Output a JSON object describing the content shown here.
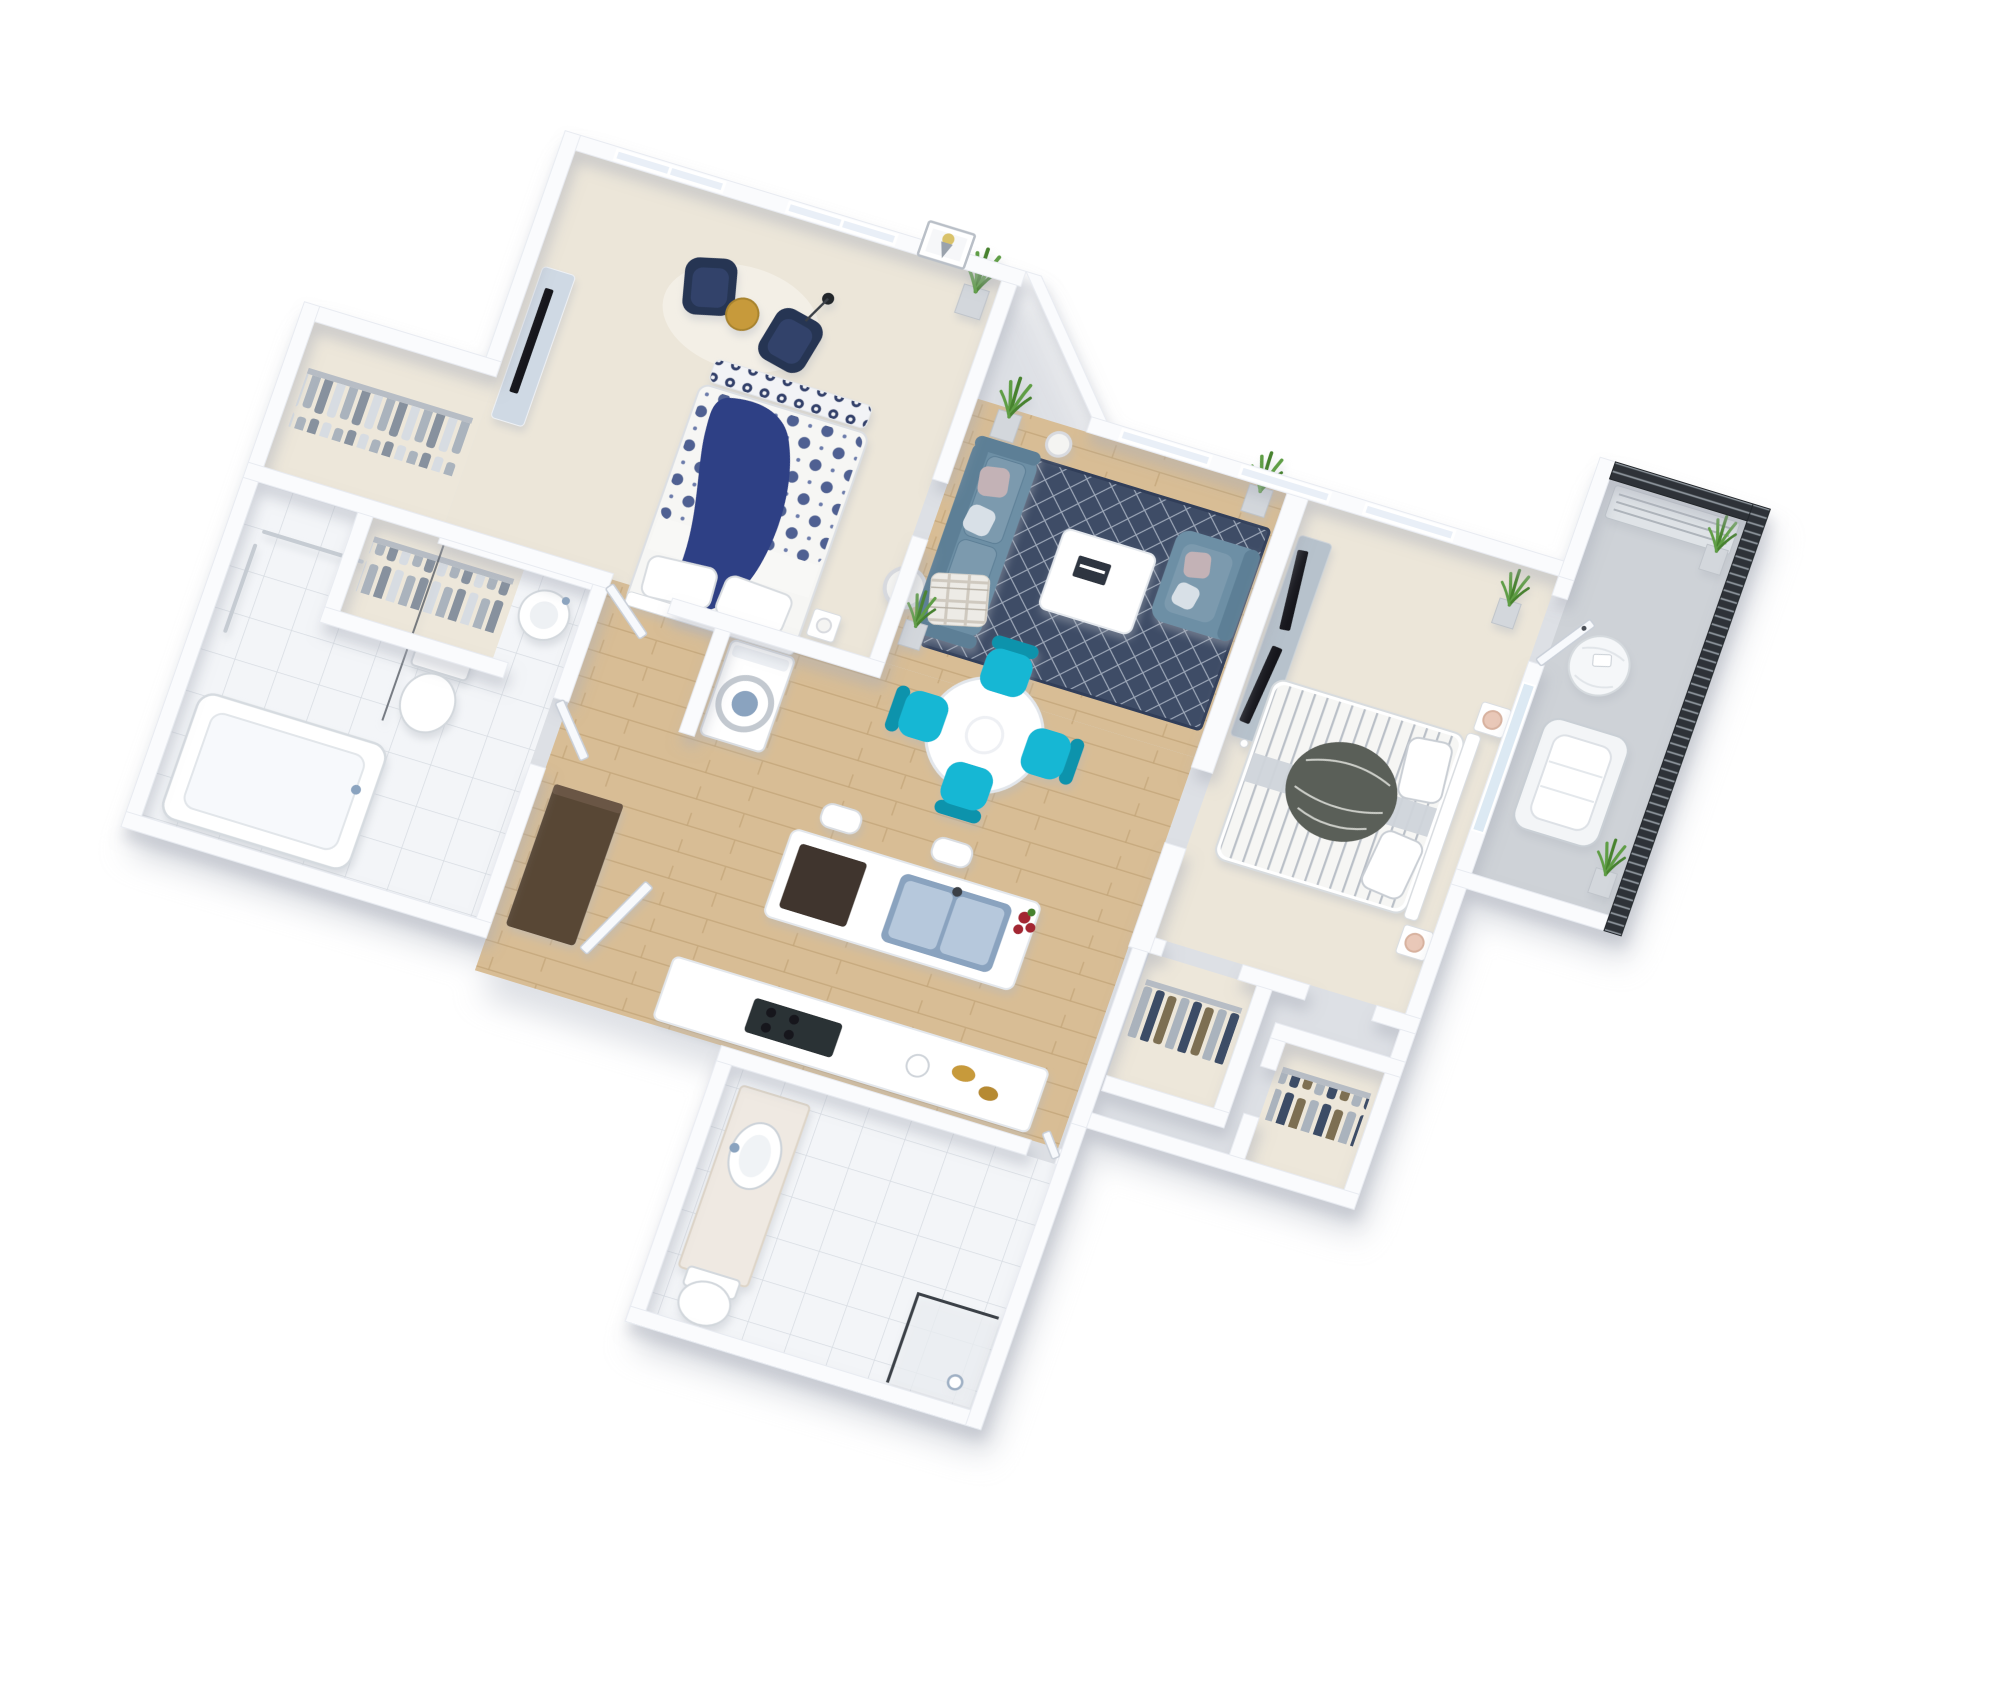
{
  "meta": {
    "kind": "3d-floorplan-render",
    "view": "isometric-dollhouse",
    "visible_text": []
  },
  "palette": {
    "bg": "#ffffff",
    "wall": "#fafbfd",
    "wall_edge": "#e8ebf1",
    "shadow": "#c3c7d0",
    "carpet": "#ece6d9",
    "carpet2": "#ede7da",
    "wood": "#d8bd95",
    "wood_line": "#c3a579",
    "tile": "#f3f5f8",
    "tile_line": "#d7dce2",
    "balcony_floor": "#ced2d7",
    "rug": "#3e4c66",
    "rug_line": "#c8d0dd",
    "window": "#e9eff7",
    "glass": "#dce9f3",
    "door": "#f7f9fc",
    "navy": "#253553",
    "navy_light": "#33436b",
    "sofa": "#6d8fa5",
    "sofa_dark": "#5d7f96",
    "sofa_cushion": "#7b9aae",
    "pillow_pink": "#c3b2b6",
    "pillow_light": "#d8e0e7",
    "teal": "#19b7d4",
    "teal_dark": "#0f93ac",
    "tv": "#16191f",
    "console": "#cfd9e4",
    "console_gray": "#b7c2cc",
    "bed_white": "#f6f6f4",
    "bed1_pattern": "#3d5188",
    "bed1_throw": "#2e4185",
    "bench_pattern": "#33406b",
    "bed2_stripe": "#b9bfc7",
    "bed2_throw": "#5a5f58",
    "wood_dark": "#594736",
    "steel": "#b6c8dc",
    "steel_dark": "#8aa3bf",
    "metal": "#3a3f46",
    "gold": "#c79a3b",
    "red": "#a32631",
    "plant": "#5f9e44",
    "plant_dark": "#47822f",
    "planter": "#d3d7dc",
    "blush": "#e9c8b8",
    "louver": "#2e3338",
    "marble": "#efe9e2",
    "clothes_a": "#d7dce2",
    "clothes_b": "#aab3bd",
    "clothes_c": "#87919e",
    "clothes_d": "#3c4c66",
    "clothes_e": "#7d6f52",
    "lamp_white": "#f4f4f2",
    "lamp_ring": "#d8dadf"
  },
  "scene": {
    "rooms": [
      {
        "id": "master-bedroom",
        "floor": "carpet",
        "items": [
          "tv-console",
          "flat-tv",
          "accent-chair",
          "accent-chair",
          "gold-side-table",
          "black-floor-lamp",
          "round-rug",
          "queen-bed",
          "navy-throw",
          "foot-bench",
          "bedside-table",
          "table-lamp",
          "potted-plant",
          "framed-art",
          "window",
          "window"
        ]
      },
      {
        "id": "walk-in-closet-master",
        "floor": "carpet",
        "items": [
          "clothes-rail",
          "hanging-clothes"
        ]
      },
      {
        "id": "linen-closet",
        "floor": "carpet",
        "items": [
          "clothes-rail",
          "hanging-clothes"
        ]
      },
      {
        "id": "master-bathroom",
        "floor": "tile",
        "items": [
          "bathtub",
          "toilet",
          "pedestal-sink",
          "grab-bars",
          "shower-glass"
        ]
      },
      {
        "id": "hallway",
        "floor": "wood",
        "items": [
          "washer-dryer",
          "tall-wardrobe",
          "door"
        ]
      },
      {
        "id": "kitchen",
        "floor": "wood",
        "items": [
          "island",
          "double-sink",
          "dishwasher",
          "bar-stool",
          "bar-stool",
          "counter",
          "cooktop",
          "bread",
          "kettle",
          "roses"
        ]
      },
      {
        "id": "dining-area",
        "floor": "wood",
        "items": [
          "round-table",
          "teal-chair",
          "teal-chair",
          "teal-chair",
          "teal-chair",
          "drum-floor-lamp"
        ]
      },
      {
        "id": "living-room",
        "floor": "wood",
        "items": [
          "sofa",
          "armchair",
          "coffee-table",
          "area-rug",
          "potted-plant",
          "potted-plant",
          "potted-plant",
          "sphere-lamp",
          "throw-plaid"
        ]
      },
      {
        "id": "bedroom-2",
        "floor": "carpet",
        "items": [
          "striped-bed",
          "knit-throw",
          "nightstand",
          "nightstand",
          "blush-lamp",
          "blush-lamp",
          "media-console",
          "flat-tv",
          "flat-tv",
          "potted-plant"
        ]
      },
      {
        "id": "closet-2a",
        "floor": "carpet",
        "items": [
          "clothes-rail",
          "hanging-clothes"
        ]
      },
      {
        "id": "closet-2b",
        "floor": "carpet",
        "items": [
          "clothes-rail",
          "hanging-clothes"
        ]
      },
      {
        "id": "bathroom-2",
        "floor": "tile",
        "items": [
          "vanity",
          "oval-sink",
          "toilet",
          "glass-shower",
          "hand-shower"
        ]
      },
      {
        "id": "balcony",
        "floor": "concrete",
        "items": [
          "louver-screen",
          "wicker-chair",
          "bean-bag",
          "card",
          "potted-plant",
          "potted-plant",
          "ac-unit"
        ]
      },
      {
        "id": "entry",
        "floor": "carpet",
        "items": [
          "entry-door",
          "potted-plant"
        ]
      }
    ]
  }
}
